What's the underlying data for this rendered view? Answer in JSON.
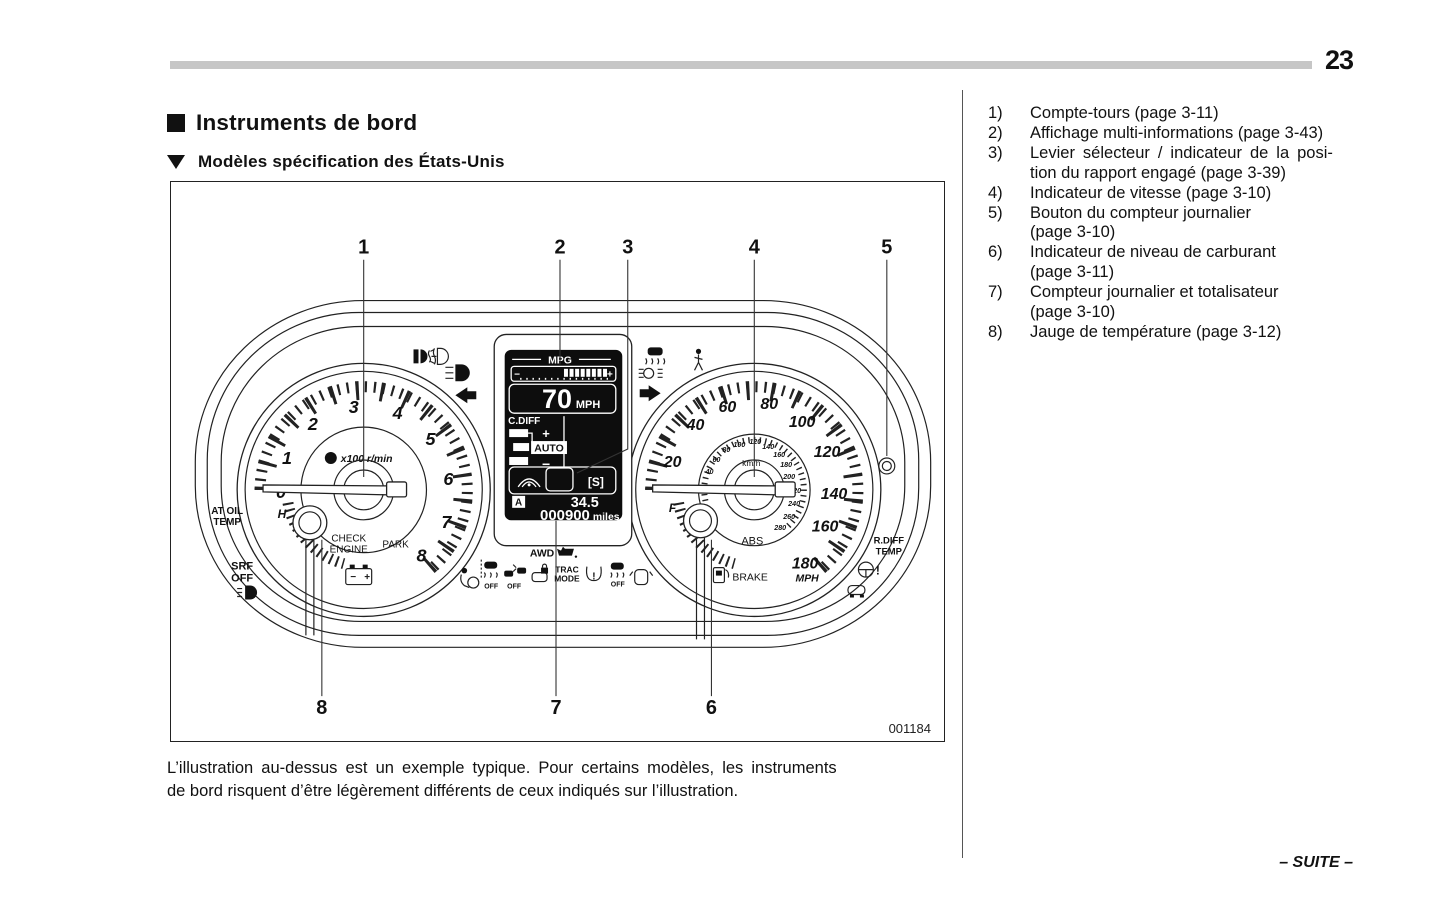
{
  "page": {
    "number": "23",
    "footer": "– SUITE –",
    "figure_code": "001184"
  },
  "header": {
    "title": "Instruments de bord",
    "subtitle": "Modèles spécification des États-Unis"
  },
  "caption": {
    "lines": [
      "L’illustration au-dessus est un exemple typique. Pour certains modèles, les instruments",
      "de bord risquent d’être légèrement différents de ceux indiqués sur l’illustration."
    ]
  },
  "legend": {
    "items": [
      {
        "num": "1)",
        "lines": [
          "Compte-tours (page 3-11)"
        ]
      },
      {
        "num": "2)",
        "lines": [
          "Affichage multi-informations (page 3-43)"
        ]
      },
      {
        "num": "3)",
        "lines": [
          "Levier sélecteur / indicateur de la posi-",
          "tion du rapport engagé (page 3-39)"
        ]
      },
      {
        "num": "4)",
        "lines": [
          "Indicateur de vitesse (page 3-10)"
        ]
      },
      {
        "num": "5)",
        "lines": [
          "Bouton du compteur journalier",
          "(page 3-10)"
        ]
      },
      {
        "num": "6)",
        "lines": [
          "Indicateur de niveau de carburant",
          "(page 3-11)"
        ]
      },
      {
        "num": "7)",
        "lines": [
          "Compteur journalier et totalisateur",
          "(page 3-10)"
        ]
      },
      {
        "num": "8)",
        "lines": [
          "Jauge de température (page 3-12)"
        ]
      }
    ]
  },
  "cluster": {
    "callouts": [
      "1",
      "2",
      "3",
      "4",
      "5",
      "6",
      "7",
      "8"
    ],
    "tachometer": {
      "scale": [
        "0",
        "1",
        "2",
        "3",
        "4",
        "5",
        "6",
        "7",
        "8"
      ],
      "unit": "x100 r/min",
      "temp_h": "H",
      "check": "CHECK",
      "engine": "ENGINE",
      "park": "PARK"
    },
    "speedometer": {
      "scale": [
        "20",
        "40",
        "60",
        "80",
        "100",
        "120",
        "140",
        "160",
        "180"
      ],
      "unit": "MPH",
      "inner_scale": [
        "20",
        "40",
        "60",
        "80",
        "100",
        "120",
        "140",
        "160",
        "180",
        "200",
        "220",
        "240",
        "260",
        "280"
      ],
      "inner_unit": "km/h",
      "fuel_f": "F",
      "abs": "ABS",
      "brake": "BRAKE"
    },
    "display": {
      "mpg_label": "MPG",
      "bar_minus": "−",
      "bar_plus": "+",
      "speed": "70",
      "speed_unit": "MPH",
      "cdiff_label": "C.DIFF",
      "cdiff_plus": "+",
      "cdiff_auto": "AUTO",
      "cdiff_minus": "−",
      "gear": "[S]",
      "trip_label": "A",
      "trip_value": "34.5",
      "odometer": "000900",
      "odometer_unit": "miles"
    },
    "outer_labels": {
      "at_oil_1": "AT OIL",
      "at_oil_2": "TEMP",
      "srf_1": "SRF",
      "srf_2": "OFF",
      "rdiff_1": "R.DIFF",
      "rdiff_2": "TEMP",
      "warning_mark": "!"
    },
    "telltales": {
      "awd": "AWD",
      "trac_1": "TRAC",
      "trac_2": "MODE",
      "off_vdc": "OFF",
      "off_es": "OFF",
      "off_trac": "OFF",
      "tpms_mark": "!"
    }
  }
}
